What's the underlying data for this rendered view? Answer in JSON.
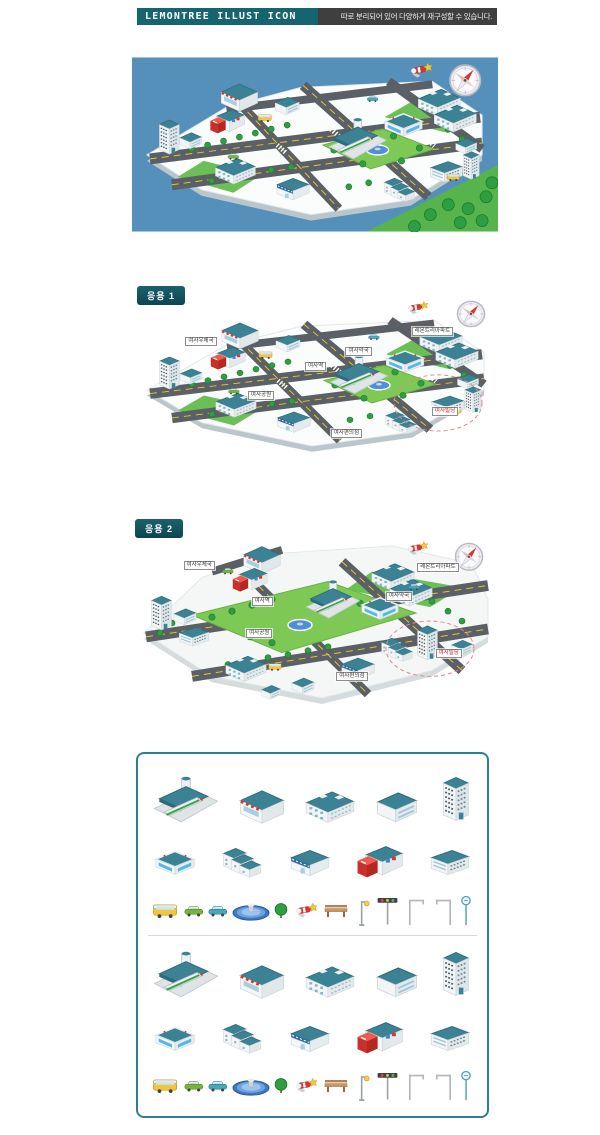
{
  "header": {
    "title": "LEMONTREE ILLUST ICON",
    "description": "따로 분리되어 있어 다양하게 재구성할 수 있습니다."
  },
  "sections": {
    "main_map": {
      "name": "레몬트리 도시 일러스트 메인"
    },
    "app1": {
      "badge": "응용 1",
      "labels": [
        {
          "text": "여사우체국",
          "x": 14.5,
          "y": 24,
          "red": false
        },
        {
          "text": "레몬트리아파트",
          "x": 76,
          "y": 17.5,
          "red": false
        },
        {
          "text": "여사약국",
          "x": 58,
          "y": 30,
          "red": false
        },
        {
          "text": "여사역",
          "x": 47,
          "y": 39,
          "red": false
        },
        {
          "text": "여사공원",
          "x": 31.5,
          "y": 57,
          "red": false
        },
        {
          "text": "여사편의점",
          "x": 54,
          "y": 80,
          "red": false
        },
        {
          "text": "여사빌딩",
          "x": 81.5,
          "y": 66.5,
          "red": true
        }
      ]
    },
    "app2": {
      "badge": "응용 2",
      "labels": [
        {
          "text": "여사우체국",
          "x": 14,
          "y": 13.5,
          "red": false
        },
        {
          "text": "레몬트리아파트",
          "x": 77.5,
          "y": 14.5,
          "red": false
        },
        {
          "text": "여사역",
          "x": 32.5,
          "y": 34.5,
          "red": false
        },
        {
          "text": "여사약국",
          "x": 69,
          "y": 32,
          "red": false
        },
        {
          "text": "여사공원",
          "x": 31,
          "y": 53.5,
          "red": false
        },
        {
          "text": "여사편의점",
          "x": 55.5,
          "y": 79,
          "red": false
        },
        {
          "text": "여사빌딩",
          "x": 82.5,
          "y": 65.5,
          "red": true
        }
      ]
    }
  },
  "icon_library": {
    "groups": [
      {
        "name": "building-icons-variant-1",
        "rows": [
          [
            "train-station",
            "market",
            "apartment",
            "small-office",
            "high-rise-tower"
          ],
          [
            "shopping-mall",
            "stepped-office",
            "signboard-shop",
            "post-office",
            "office-block"
          ],
          [
            "bus",
            "car-green",
            "car-teal",
            "fountain",
            "tree",
            "rocket-toy",
            "bench",
            "street-lamp",
            "traffic-light",
            "corner-pole-left",
            "corner-pole-right",
            "bus-stop-sign"
          ]
        ]
      },
      {
        "name": "building-icons-variant-2",
        "rows": [
          [
            "train-station",
            "market",
            "apartment",
            "small-office",
            "high-rise-tower"
          ],
          [
            "shopping-mall",
            "stepped-office",
            "signboard-shop",
            "post-office",
            "office-block"
          ],
          [
            "bus",
            "car-green",
            "car-teal",
            "fountain",
            "tree",
            "rocket-toy",
            "bench",
            "street-lamp",
            "traffic-light",
            "corner-pole-left",
            "corner-pole-right",
            "bus-stop-sign"
          ]
        ]
      }
    ]
  },
  "colors": {
    "accent_teal": "#156570",
    "badge_teal": "#0d4551",
    "header_dark": "#3f3f3f",
    "sky_blue": "#5590bb",
    "road_gray": "#5a6065",
    "lane_yellow": "#e6c233",
    "grass_green": "#5cb54d",
    "park_green": "#7ec855",
    "roof_teal": "#3a8294",
    "postbox_red": "#d8372f",
    "highlight_red": "#cc3333",
    "panel_border": "#2b7f91"
  }
}
